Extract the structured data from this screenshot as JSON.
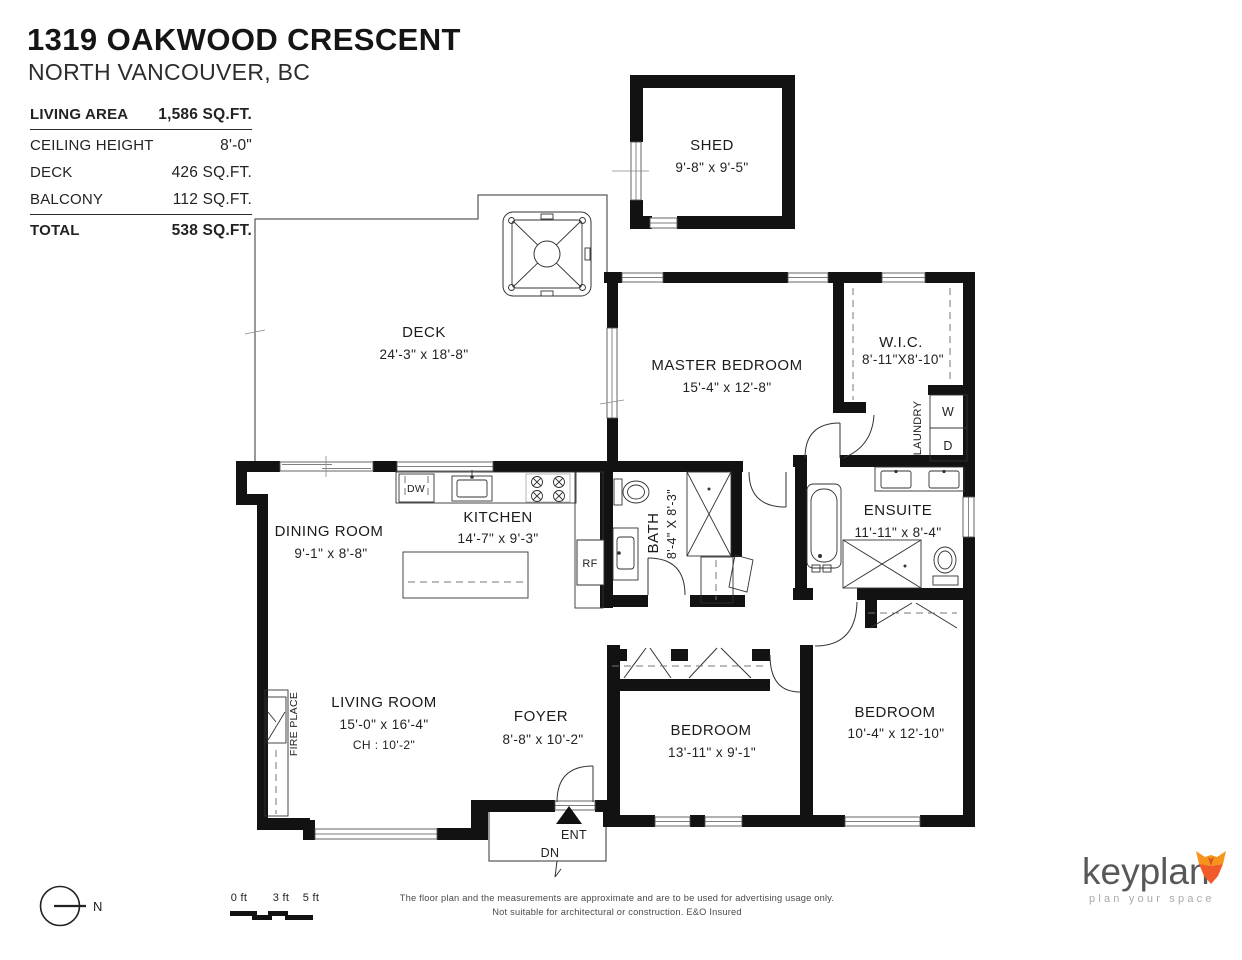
{
  "header": {
    "title": "1319 OAKWOOD CRESCENT",
    "subtitle": "NORTH VANCOUVER, BC",
    "stats": [
      {
        "label": "LIVING AREA",
        "value": "1,586 SQ.FT."
      },
      {
        "label": "CEILING HEIGHT",
        "value": "8'-0\""
      },
      {
        "label": "DECK",
        "value": "426 SQ.FT."
      },
      {
        "label": "BALCONY",
        "value": "112 SQ.FT."
      },
      {
        "label": "TOTAL",
        "value": "538 SQ.FT."
      }
    ]
  },
  "rooms": {
    "shed": {
      "name": "SHED",
      "dims": "9'-8\" x 9'-5\""
    },
    "deck": {
      "name": "DECK",
      "dims": "24'-3\" x 18'-8\""
    },
    "master_bedroom": {
      "name": "MASTER BEDROOM",
      "dims": "15'-4\" x 12'-8\""
    },
    "wic": {
      "name": "W.I.C.",
      "dims": "8'-11\"X8'-10\""
    },
    "laundry": {
      "name": "LAUNDRY"
    },
    "dining_room": {
      "name": "DINING ROOM",
      "dims": "9'-1\" x 8'-8\""
    },
    "kitchen": {
      "name": "KITCHEN",
      "dims": "14'-7\" x 9'-3\""
    },
    "bath": {
      "name": "BATH",
      "dims": "8'-4\" X 8'-3\""
    },
    "ensuite": {
      "name": "ENSUITE",
      "dims": "11'-11\" x 8'-4\""
    },
    "living_room": {
      "name": "LIVING ROOM",
      "dims": "15'-0\" x 16'-4\"",
      "ceiling": "CH : 10'-2\""
    },
    "fireplace": {
      "name": "FIRE PLACE"
    },
    "foyer": {
      "name": "FOYER",
      "dims": "8'-8\" x 10'-2\""
    },
    "bedroom1": {
      "name": "BEDROOM",
      "dims": "13'-11\" x 9'-1\""
    },
    "bedroom2": {
      "name": "BEDROOM",
      "dims": "10'-4\" x 12'-10\""
    }
  },
  "fixtures": {
    "dw": "DW",
    "rf": "RF",
    "washer": "W",
    "dryer": "D"
  },
  "entry": {
    "ent": "ENT",
    "dn": "DN"
  },
  "compass": {
    "north": "N"
  },
  "scale_bar": {
    "labels": [
      "0 ft",
      "3 ft",
      "5 ft"
    ]
  },
  "disclaimer": {
    "line1": "The floor plan and the measurements are approximate and are to be used for advertising usage only.",
    "line2": "Not suitable for architectural or construction. E&O Insured"
  },
  "brand": {
    "name": "keyplan",
    "tagline": "plan your space"
  },
  "colors": {
    "wall": "#121212",
    "fox_orange": "#f7941e",
    "fox_red": "#f15a29",
    "brand_gray": "#57585a",
    "tagline_gray": "#a8aaad"
  }
}
